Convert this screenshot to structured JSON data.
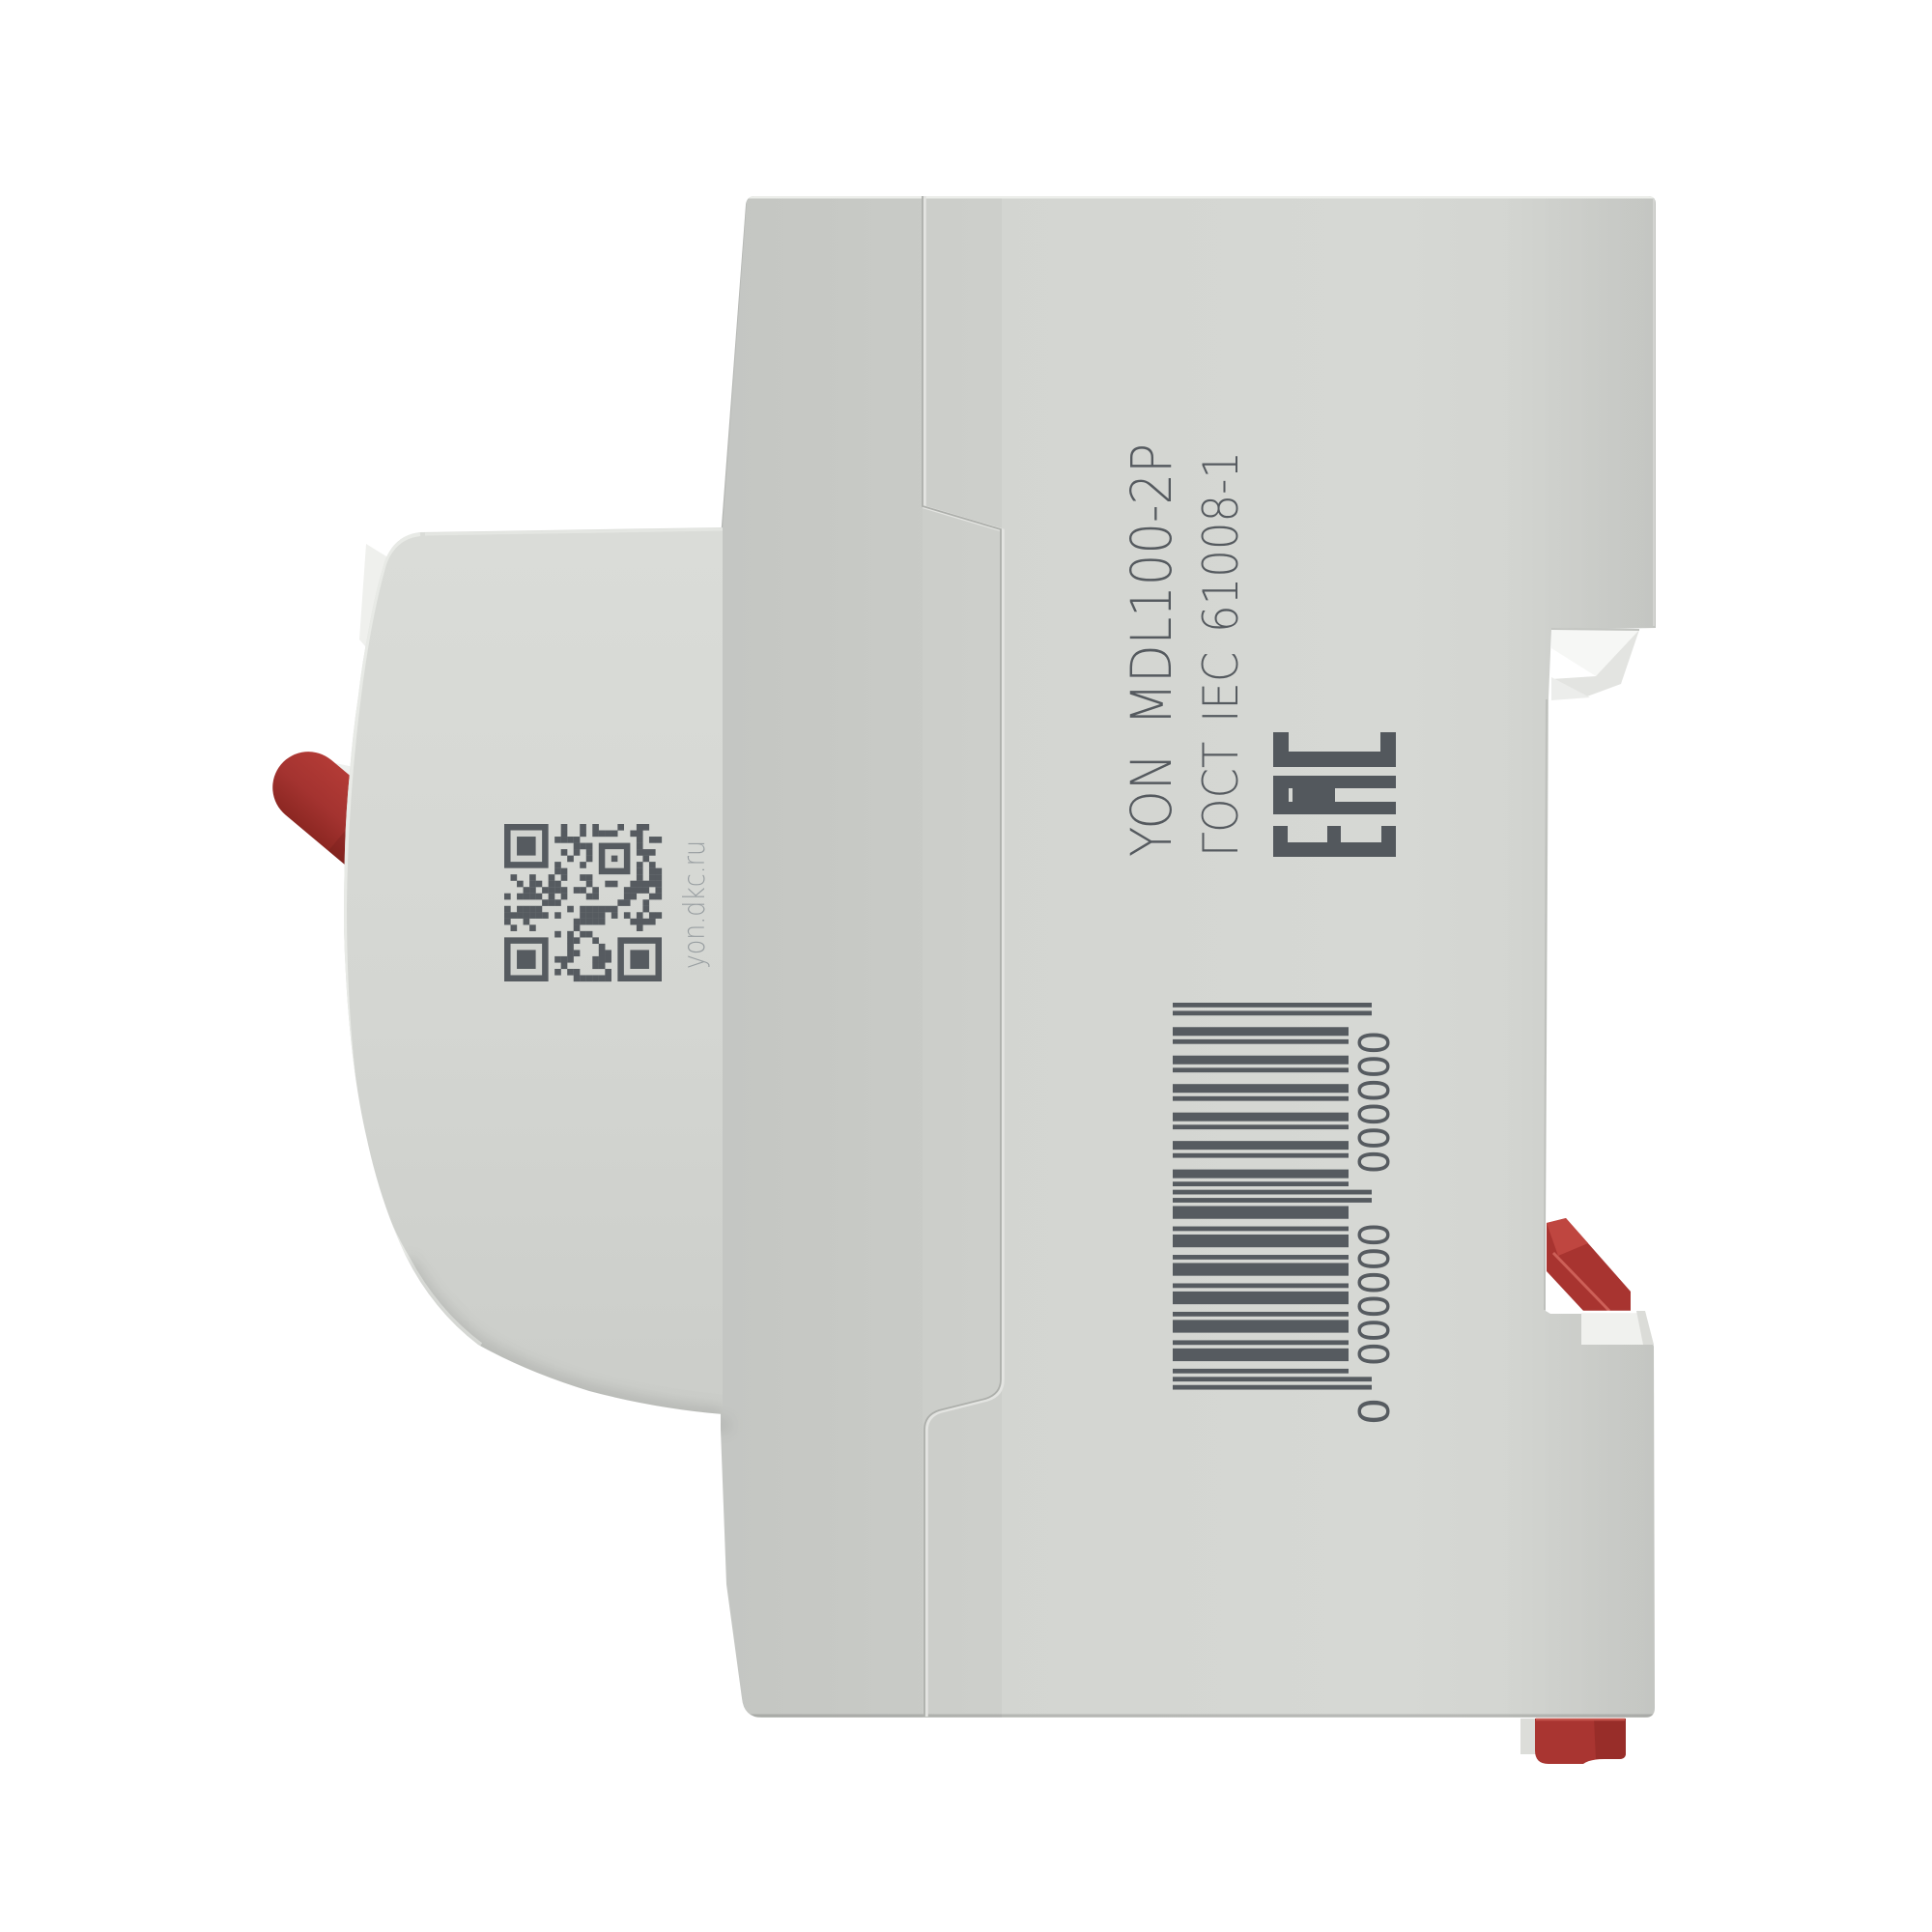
{
  "scene": {
    "type": "product-photo",
    "background": "#ffffff"
  },
  "device": {
    "side_label": {
      "model": "YON MDL100-2P",
      "standard": "ГОСТ IEC 61008-1",
      "certification_mark": "ЕАС"
    },
    "qr": {
      "caption": "yon.dkc.ru",
      "modules": 25
    },
    "barcode": {
      "display": "0 000000 000000",
      "value": "0000000000000",
      "leading": "0",
      "group1": "000000",
      "group2": "000000"
    },
    "colors": {
      "body": "#d1d3cf",
      "body_dark": "#c7c9c5",
      "housing_light": "#d9dbd7",
      "ink": "#565b60",
      "ink_dark": "#53585d",
      "ink_light": "#989ea1",
      "red": "#a93531",
      "red_dark": "#8c2722",
      "red_bright": "#c14a42",
      "white_part": "#f2f3f0",
      "seam": "#aeb0ac"
    }
  }
}
